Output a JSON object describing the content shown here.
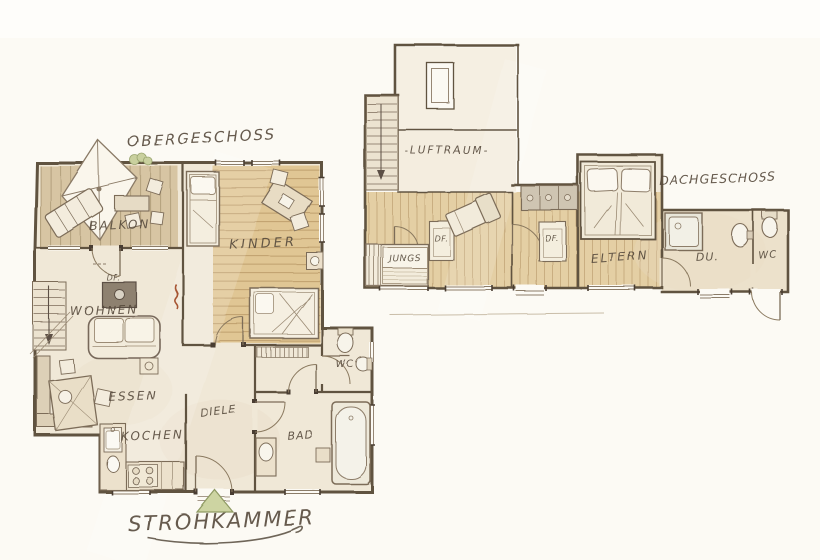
{
  "sheet": {
    "type": "hand-drawn floor plan sketch",
    "footer_label": "STROHKAMMER",
    "colors": {
      "paper": "#fcfaf4",
      "room_cream": "#f0e8d7",
      "wood_floor_kinder": "#e0c694",
      "wood_floor_balcony": "#d7c5a3",
      "wood_floor_dach": "#e4cfa4",
      "wall_ink": "#60523f",
      "label_ink": "#564a3c",
      "entrance_green": "#cdd4a2",
      "flame_red": "#a65432"
    }
  },
  "obergeschoss": {
    "title": "OBERGESCHOSS",
    "rooms": {
      "balkon": "BALKON",
      "kinder": "KINDER",
      "wohnen": "WOHNEN",
      "essen": "ESSEN",
      "kochen": "KOCHEN",
      "diele": "DIELE",
      "bad": "BAD",
      "wc": "WC",
      "df": "DF."
    }
  },
  "dachgeschoss": {
    "title": "DACHGESCHOSS",
    "rooms": {
      "luftraum": "-LUFTRAUM-",
      "jungs": "JUNGS",
      "df1": "DF.",
      "df2": "DF.",
      "eltern": "ELTERN",
      "du": "DU.",
      "wc": "WC"
    }
  }
}
